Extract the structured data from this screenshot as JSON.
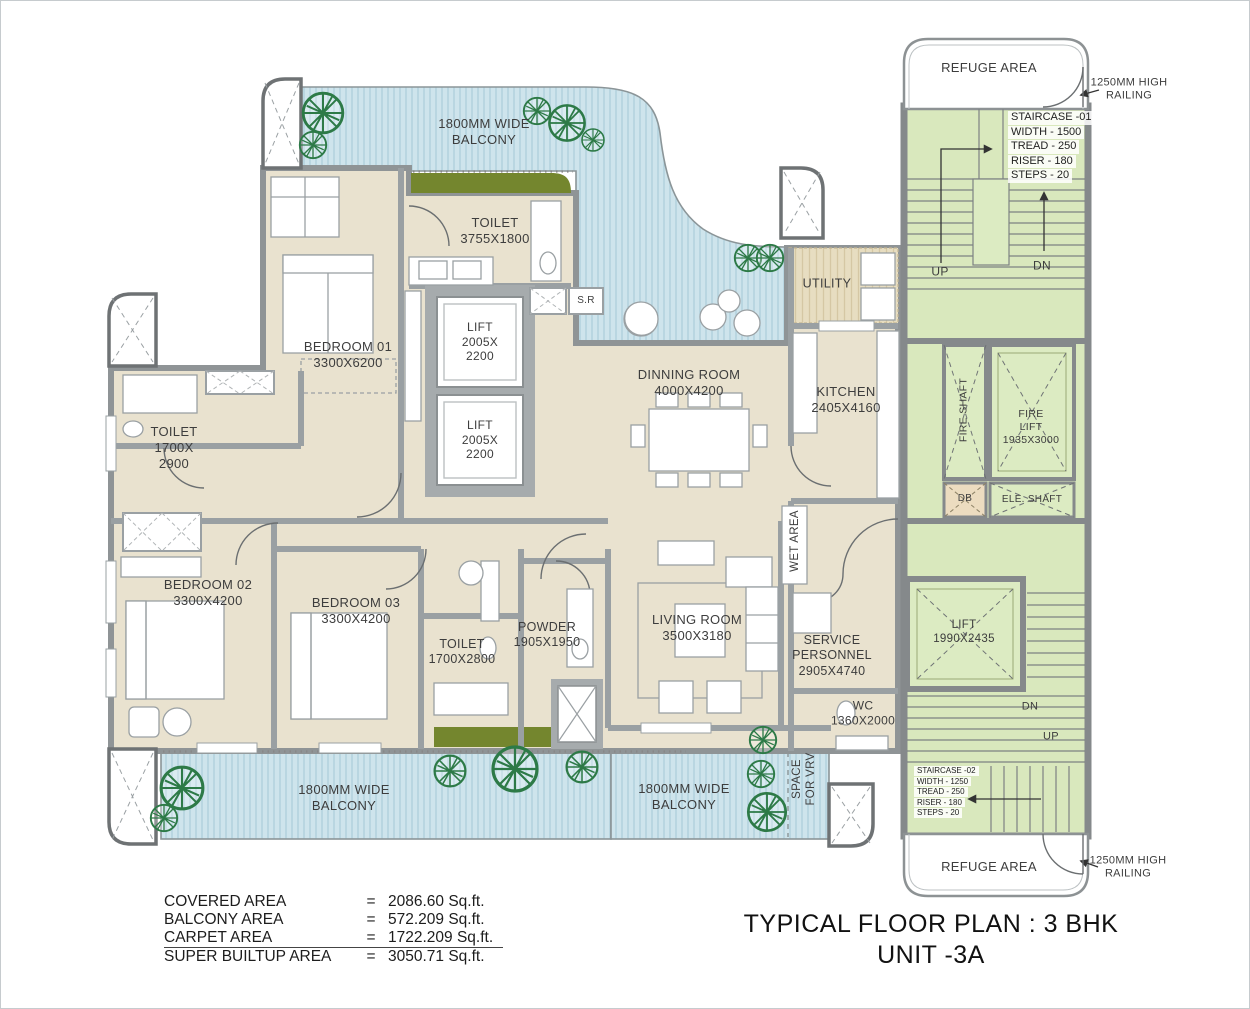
{
  "title": {
    "line1": "TYPICAL FLOOR PLAN : 3 BHK",
    "line2": "UNIT -3A"
  },
  "area_table": {
    "rows": [
      {
        "label": "COVERED AREA",
        "eq": "=",
        "value": "2086.60 Sq.ft."
      },
      {
        "label": "BALCONY AREA",
        "eq": "=",
        "value": "572.209 Sq.ft."
      },
      {
        "label": "CARPET AREA",
        "eq": "=",
        "value": "1722.209 Sq.ft."
      },
      {
        "label": "SUPER BUILTUP AREA",
        "eq": "=",
        "value": "3050.71 Sq.ft."
      }
    ]
  },
  "rooms": {
    "balcony_top": "1800MM WIDE\nBALCONY",
    "balcony_bottom_left": "1800MM WIDE\nBALCONY",
    "balcony_bottom_mid": "1800MM WIDE\nBALCONY",
    "space_vrv": "SPACE\nFOR VRV",
    "bedroom01": "BEDROOM 01\n3300X6200",
    "bedroom02": "BEDROOM 02\n3300X4200",
    "bedroom03": "BEDROOM 03\n3300X4200",
    "toilet_top": "TOILET\n3755X1800",
    "toilet_left": "TOILET\n1700X\n2900",
    "toilet_mid": "TOILET\n1700X2800",
    "powder": "POWDER\n1905X1950",
    "living": "LIVING ROOM\n3500X3180",
    "dining": "DINNING ROOM\n4000X4200",
    "kitchen": "KITCHEN\n2405X4160",
    "utility": "UTILITY",
    "wet_area": "WET AREA",
    "service": "SERVICE\nPERSONNEL\n2905X4740",
    "wc": "WC\n1360X2000",
    "lift_a": "LIFT\n2005X\n2200",
    "lift_b": "LIFT\n2005X\n2200",
    "sr": "S.R"
  },
  "core": {
    "refuge_top": "REFUGE AREA",
    "refuge_bottom": "REFUGE AREA",
    "railing_top": "1250MM HIGH\nRAILING",
    "railing_bottom": "1250MM HIGH\nRAILING",
    "staircase1": {
      "lines": [
        "STAIRCASE -01",
        "WIDTH - 1500",
        "TREAD - 250",
        "RISER - 180",
        "STEPS - 20"
      ],
      "up": "UP",
      "dn": "DN"
    },
    "staircase2": {
      "lines": [
        "STAIRCASE -02",
        "WIDTH - 1250",
        "TREAD - 250",
        "RISER - 180",
        "STEPS - 20"
      ],
      "up": "UP",
      "dn": "DN"
    },
    "fire_shaft": "FIRE SHAFT",
    "fire_lift": "FIRE\nLIFT\n1935X3000",
    "db": "DB",
    "ele_shaft": "ELE. SHAFT",
    "lift_c": "LIFT\n1990X2435"
  },
  "colors": {
    "room_beige": "#e9e2cf",
    "balcony_blue": "#cee4ec",
    "balcony_stripe": "#a8cbd8",
    "core_green": "#d9e8bd",
    "shaft_green": "#dcebc2",
    "planter_olive": "#74862e",
    "wall_gray": "#9aa0a3",
    "outer_wall": "#85898b",
    "tree_green": "#2d7a47",
    "utility_tan": "#e7ddc1",
    "db_tan": "#ecdcc0",
    "text": "#3d3d3d"
  }
}
